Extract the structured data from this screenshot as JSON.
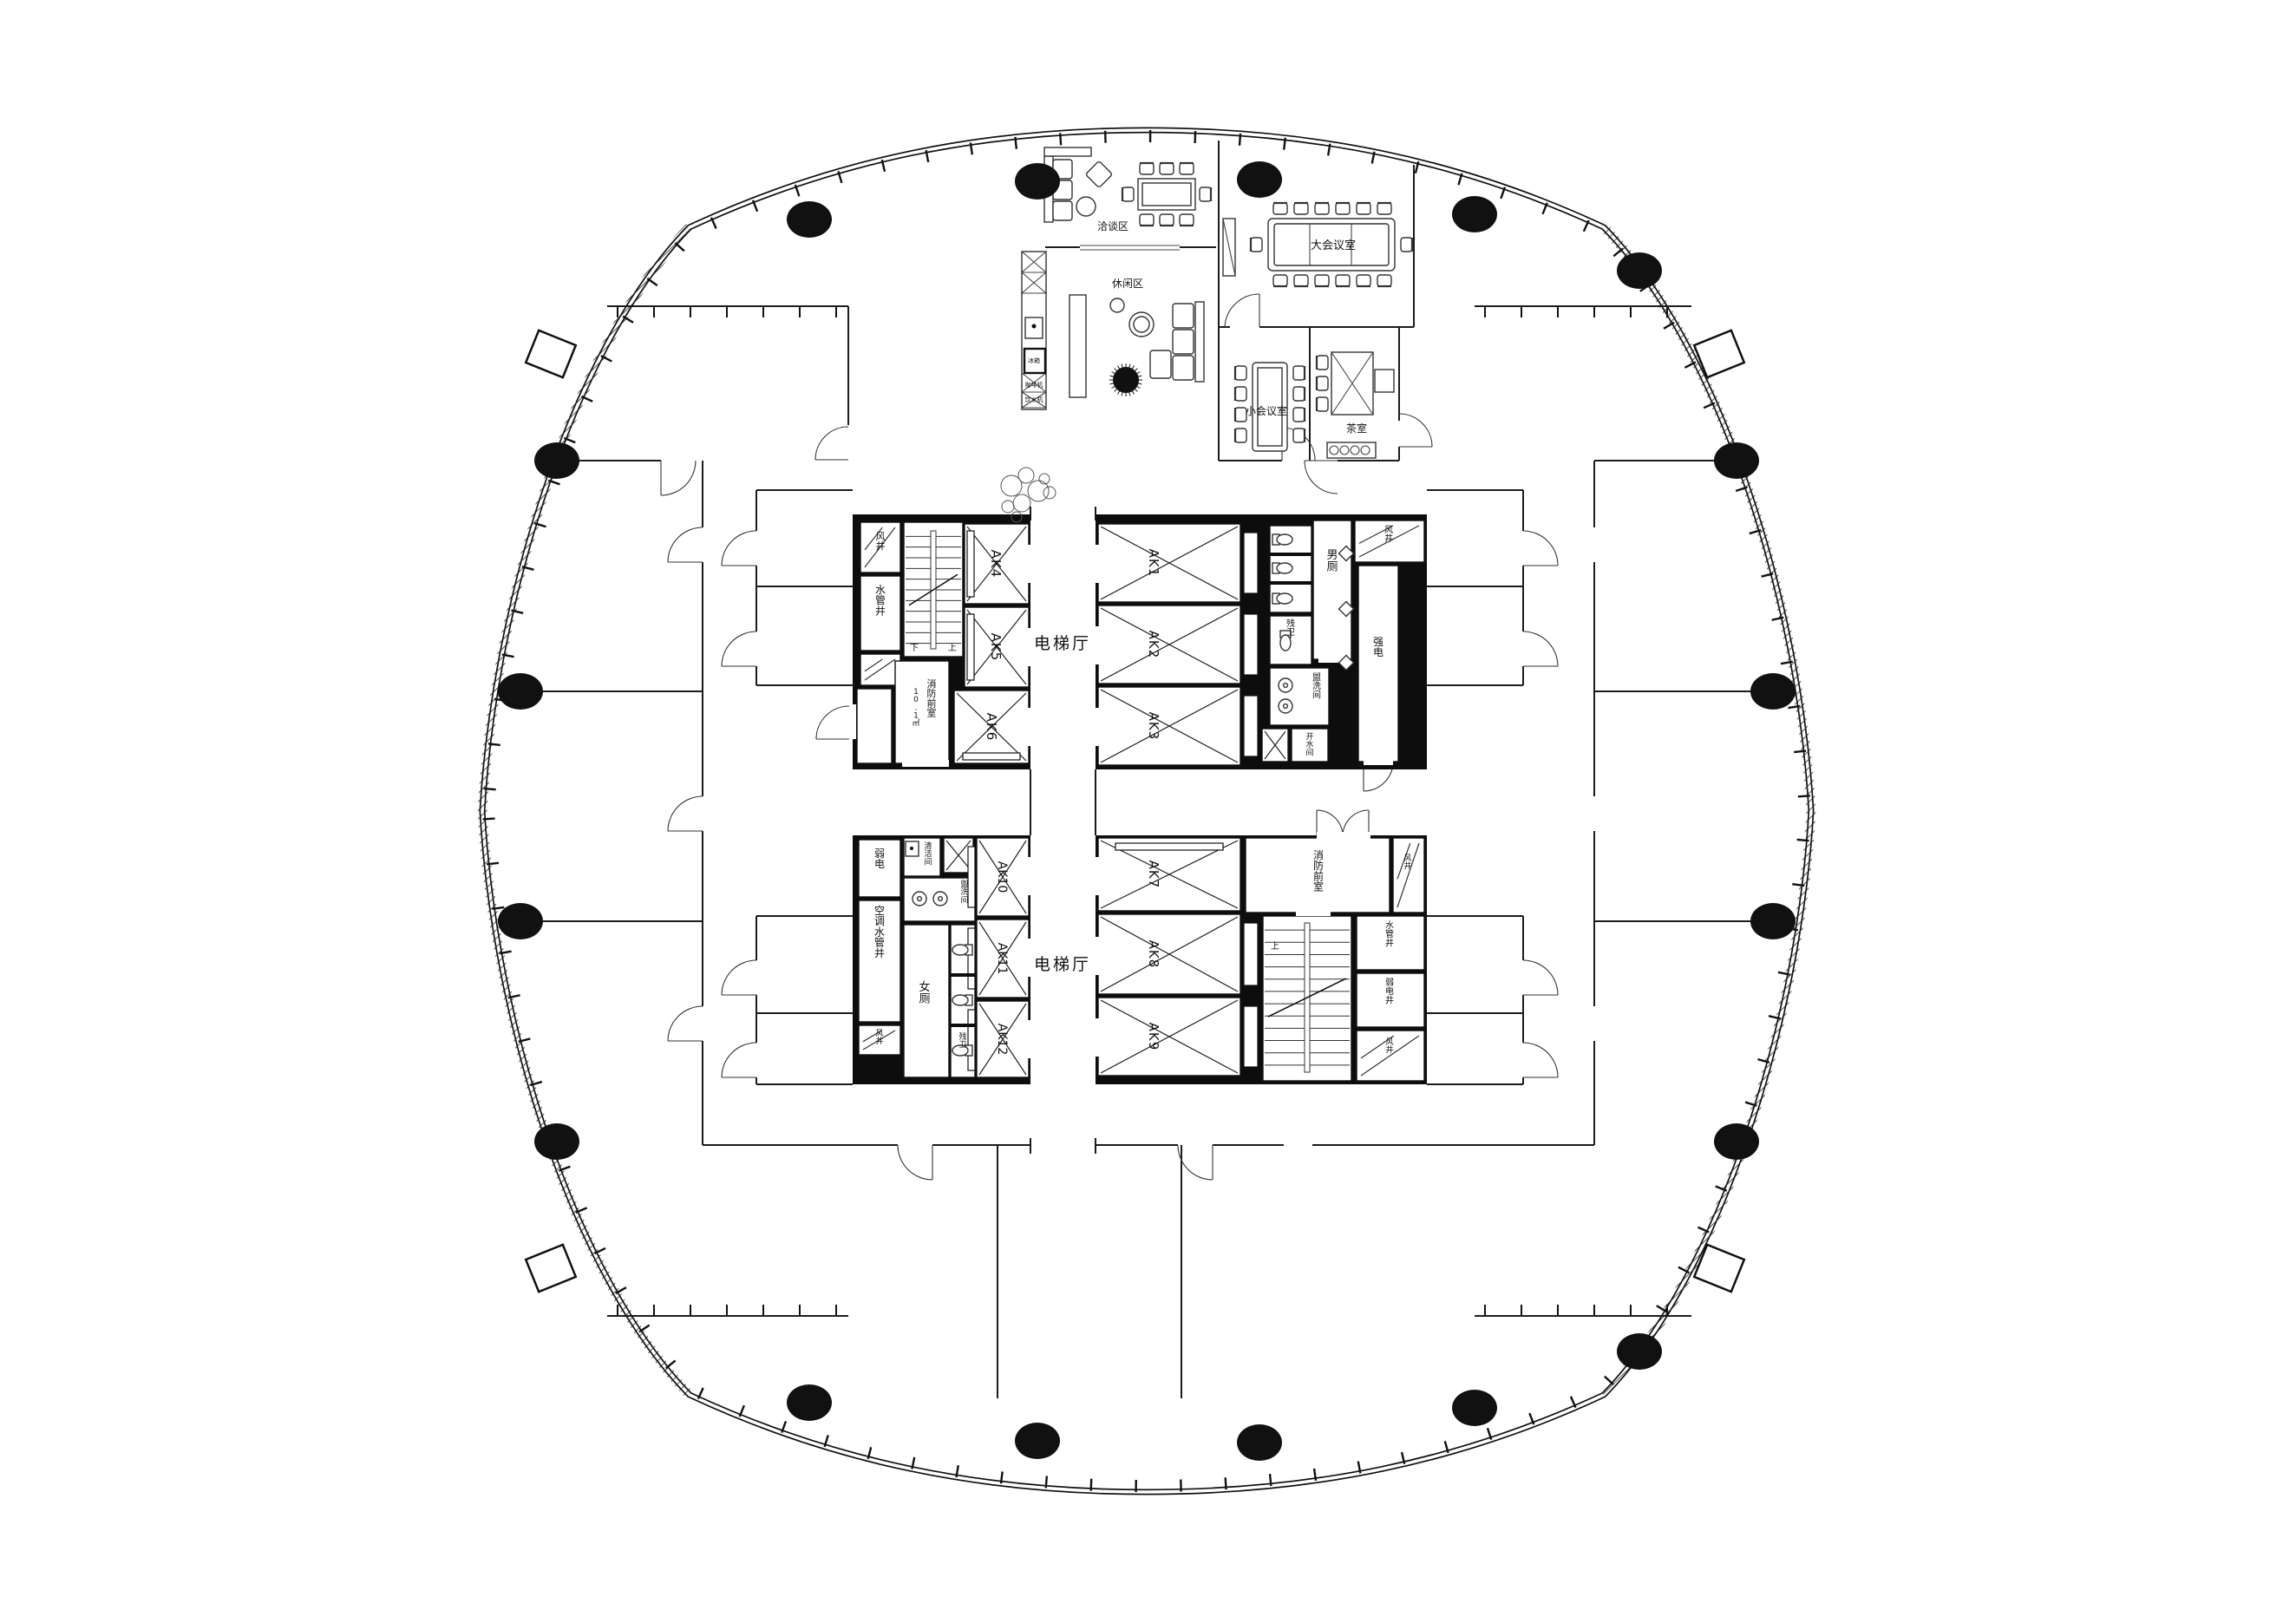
{
  "drawing": {
    "type": "office-tower-standard-floor-plan",
    "colors": {
      "line": "#1c1c1c",
      "wall": "#0d0d0d",
      "background": "#ffffff"
    }
  },
  "labels": {
    "elevator_hall": "电梯厅",
    "ak1": "AK1",
    "ak2": "AK2",
    "ak3": "AK3",
    "ak4": "AK4",
    "ak5": "AK5",
    "ak6": "AK6",
    "ak7": "AK7",
    "ak8": "AK8",
    "ak9": "AK9",
    "ak10": "AK10",
    "ak11": "AK11",
    "ak12": "AK12",
    "wind_shaft": "风井",
    "water_shaft": "水管井",
    "ac_water_shaft": "空调水管井",
    "weak_electric": "弱电",
    "weak_electric_shaft": "弱电井",
    "strong_electric": "强电",
    "fire_lobby": "消防前室",
    "fire_lobby_area": "10.1㎡",
    "mens_toilet": "男厕",
    "womens_toilet": "女厕",
    "accessible_wc": "残卫",
    "washroom": "盥洗间",
    "hot_water_room": "开水间",
    "cleaning_room": "清洁间",
    "up": "上",
    "down": "下",
    "negotiation_area": "洽谈区",
    "leisure_area": "休闲区",
    "large_meeting_room": "大会议室",
    "small_meeting_room": "小会议室",
    "tea_room": "茶室",
    "fridge": "冰箱",
    "coffee_machine": "咖啡机",
    "water_dispenser": "饮水机"
  }
}
